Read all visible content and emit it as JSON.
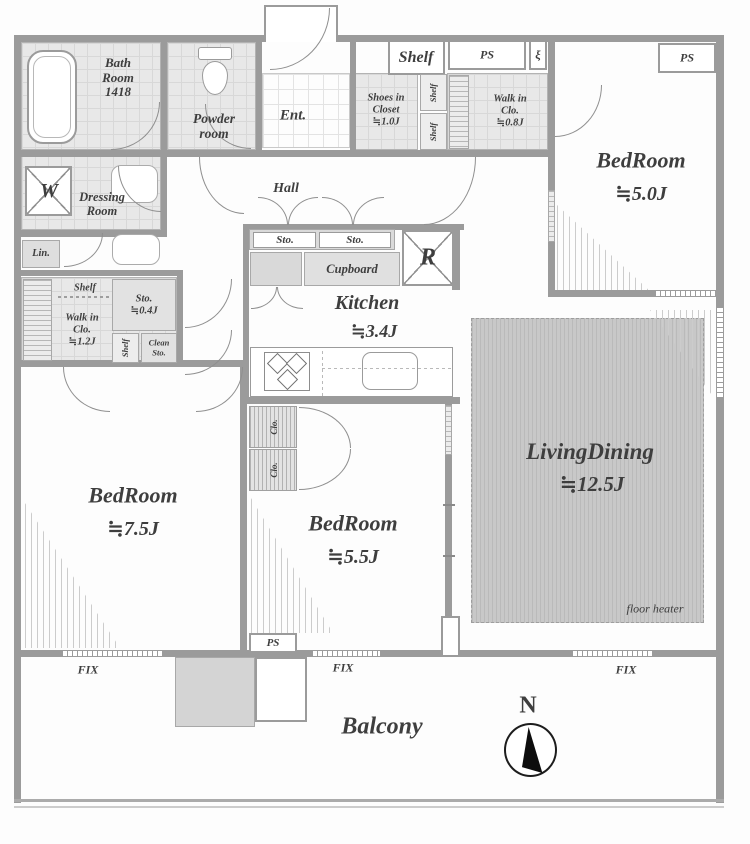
{
  "labels": {
    "bath": "Bath\nRoom\n1418",
    "powder": "Powder\nroom",
    "entrance": "Ent.",
    "hall": "Hall",
    "shelf": "Shelf",
    "shoes_closet": "Shoes in\nCloset\n≒1.0J",
    "ps": "PS",
    "meter_symbol": "ξ",
    "walkin_closet_ne": "Walk in\nClo.\n≒0.8J",
    "bedroom_ne": "BedRoom",
    "bedroom_ne_size": "≒5.0J",
    "dressing": "Dressing\nRoom",
    "washer": "W",
    "linen": "Lin.",
    "walkin_closet_w": "Walk in\nClo.\n≒1.2J",
    "storage_small": "Sto.\n≒0.4J",
    "clean_storage": "Clean\nSto.",
    "storage": "Sto.",
    "cupboard": "Cupboard",
    "fridge": "R",
    "kitchen": "Kitchen",
    "kitchen_size": "≒3.4J",
    "closet": "Clo.",
    "bedroom_w": "BedRoom",
    "bedroom_w_size": "≒7.5J",
    "bedroom_s": "BedRoom",
    "bedroom_s_size": "≒5.5J",
    "living": "LivingDining",
    "living_size": "≒12.5J",
    "floor_heater": "floor heater",
    "fix": "FIX",
    "balcony": "Balcony",
    "north": "N"
  }
}
